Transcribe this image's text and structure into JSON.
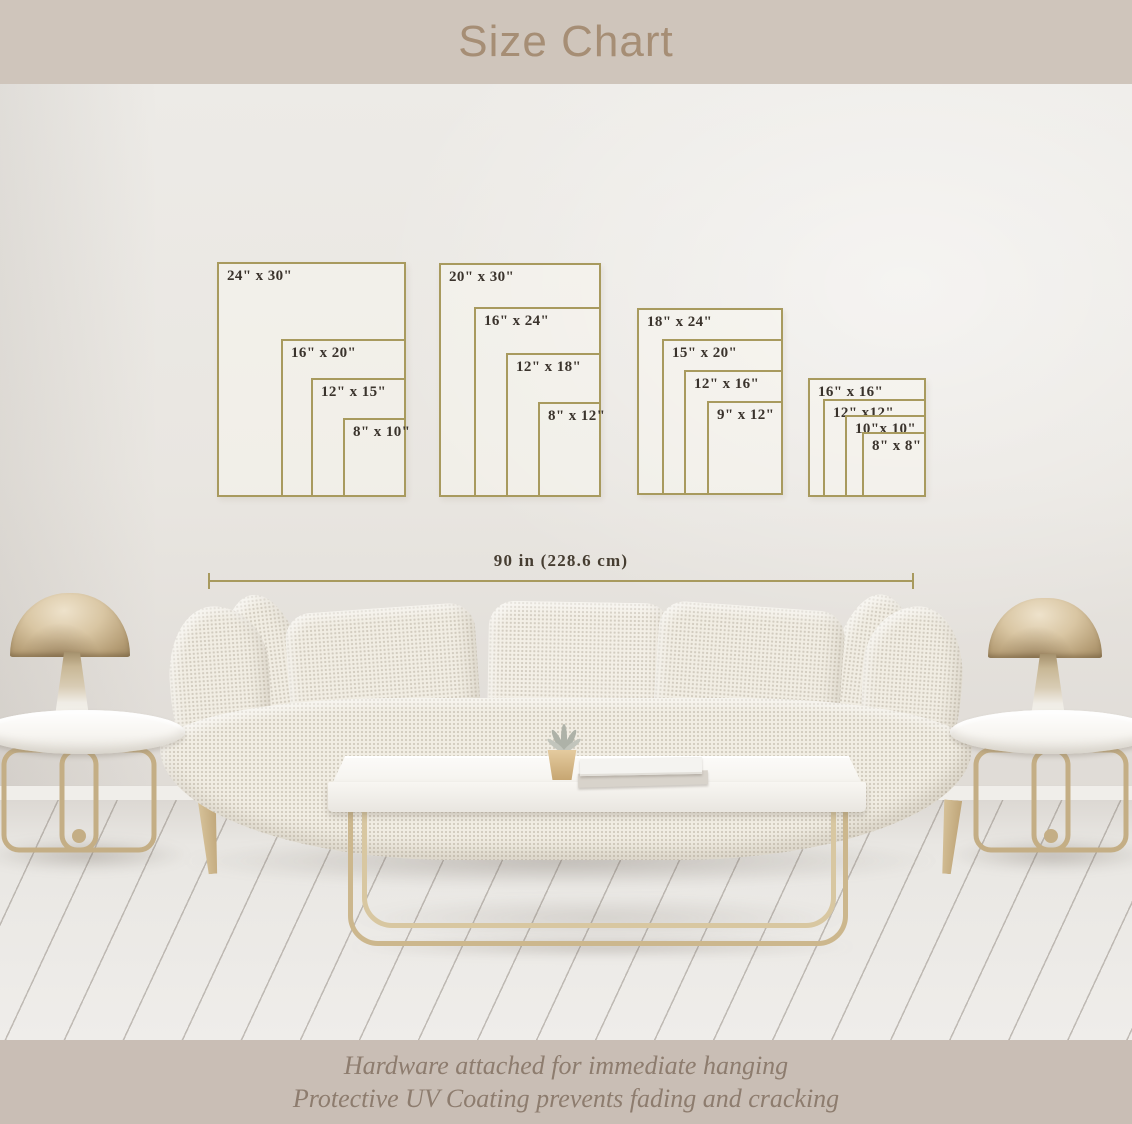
{
  "header": {
    "title": "Size Chart"
  },
  "footer": {
    "line1": "Hardware attached for immediate hanging",
    "line2": "Protective UV Coating prevents fading and cracking"
  },
  "ruler": {
    "label": "90 in (228.6 cm)"
  },
  "size_chart": {
    "groups": [
      {
        "id": "portrait-4x5",
        "frames": [
          {
            "label": "24\" x 30\"",
            "x": 217,
            "y": 262,
            "w": 189,
            "h": 235
          },
          {
            "label": "16\" x 20\"",
            "x": 281,
            "y": 339,
            "w": 125,
            "h": 158
          },
          {
            "label": "12\" x 15\"",
            "x": 311,
            "y": 378,
            "w": 95,
            "h": 119
          },
          {
            "label": "8\" x 10\"",
            "x": 343,
            "y": 418,
            "w": 63,
            "h": 79
          }
        ]
      },
      {
        "id": "portrait-2x3",
        "frames": [
          {
            "label": "20\" x 30\"",
            "x": 439,
            "y": 263,
            "w": 162,
            "h": 234
          },
          {
            "label": "16\" x 24\"",
            "x": 474,
            "y": 307,
            "w": 127,
            "h": 190
          },
          {
            "label": "12\" x 18\"",
            "x": 506,
            "y": 353,
            "w": 95,
            "h": 144
          },
          {
            "label": "8\" x 12\"",
            "x": 538,
            "y": 402,
            "w": 63,
            "h": 95
          }
        ]
      },
      {
        "id": "portrait-3x4",
        "frames": [
          {
            "label": "18\" x 24\"",
            "x": 637,
            "y": 308,
            "w": 146,
            "h": 187
          },
          {
            "label": "15\" x 20\"",
            "x": 662,
            "y": 339,
            "w": 121,
            "h": 156
          },
          {
            "label": "12\" x 16\"",
            "x": 684,
            "y": 370,
            "w": 99,
            "h": 125
          },
          {
            "label": "9\" x 12\"",
            "x": 707,
            "y": 401,
            "w": 76,
            "h": 94
          }
        ]
      },
      {
        "id": "square",
        "frames": [
          {
            "label": "16\" x 16\"",
            "x": 808,
            "y": 378,
            "w": 118,
            "h": 119
          },
          {
            "label": "12\" x12\"",
            "x": 823,
            "y": 399,
            "w": 103,
            "h": 98
          },
          {
            "label": "10\"x 10\"",
            "x": 845,
            "y": 415,
            "w": 81,
            "h": 82
          },
          {
            "label": "8\" x 8\"",
            "x": 862,
            "y": 432,
            "w": 64,
            "h": 65
          }
        ]
      }
    ]
  },
  "colors": {
    "banner_top_bg": "#cfc5bb",
    "banner_bottom_bg": "#c9beb5",
    "title_text": "#a68e75",
    "footer_text": "#8d7c6e",
    "frame_border": "#a89a5e",
    "frame_label": "#3a332c",
    "frame_fill": "rgba(248,245,238,0.55)",
    "ruler_line": "#a89a5e",
    "ruler_text": "#463d31"
  }
}
